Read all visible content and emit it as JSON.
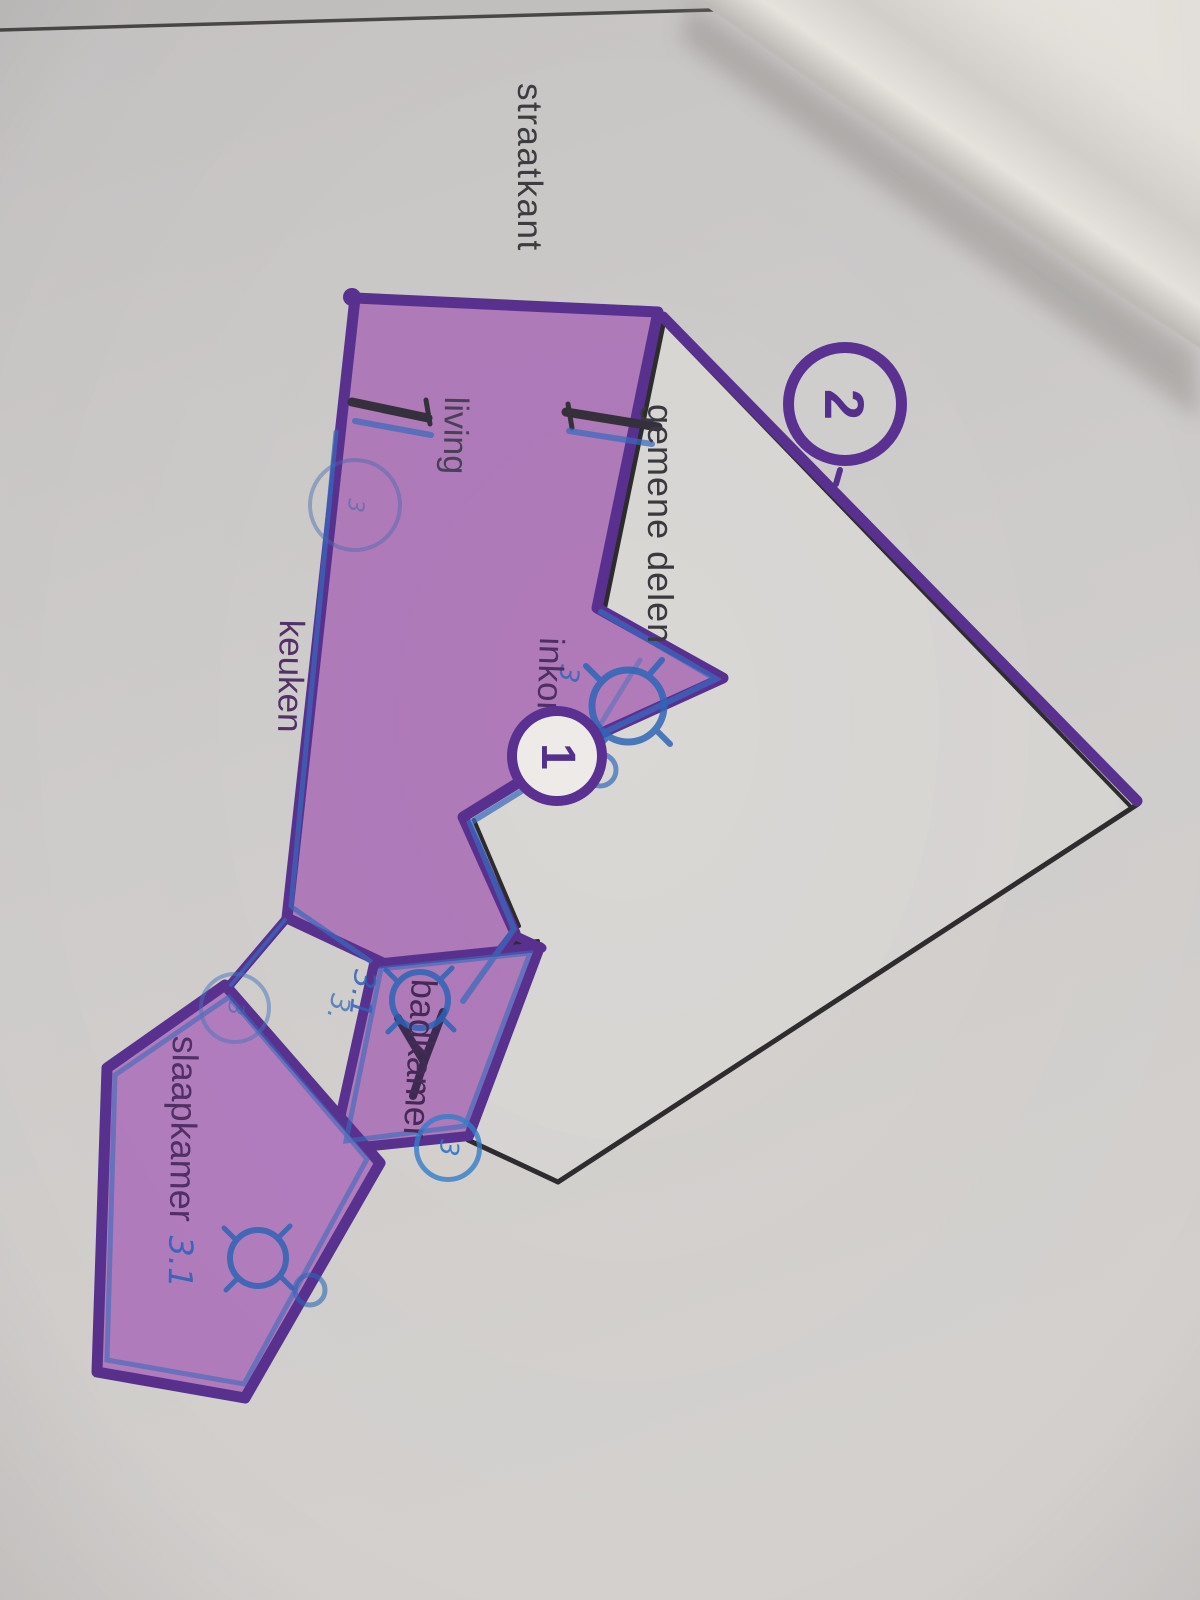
{
  "photo": {
    "street_side_label": "straatkant",
    "rooms": [
      {
        "name": "gemene-delen",
        "label": "gemene delen"
      },
      {
        "name": "living",
        "label": "living"
      },
      {
        "name": "keuken",
        "label": "keuken"
      },
      {
        "name": "inkom",
        "label": "inkom"
      },
      {
        "name": "slaapkamer",
        "label": "slaapkamer",
        "unit": "3.1"
      },
      {
        "name": "badkamer",
        "label": "badkamer"
      }
    ],
    "unit_markers": [
      {
        "number": "1"
      },
      {
        "number": "2"
      }
    ],
    "pen_annotations": {
      "bathroom_unit": "3.1",
      "kitchen_mark": "3.",
      "hall_mark": "3",
      "living_circle": "3",
      "bedroom_circle": "3",
      "bathroom_circle": "3"
    },
    "colors": {
      "highlight_fill": "#b17bba",
      "outline_purple": "#5a3190",
      "pen_blue": "#2f63b8",
      "wall_ink": "#2e2c2e",
      "paper": "#d0cecc"
    }
  }
}
